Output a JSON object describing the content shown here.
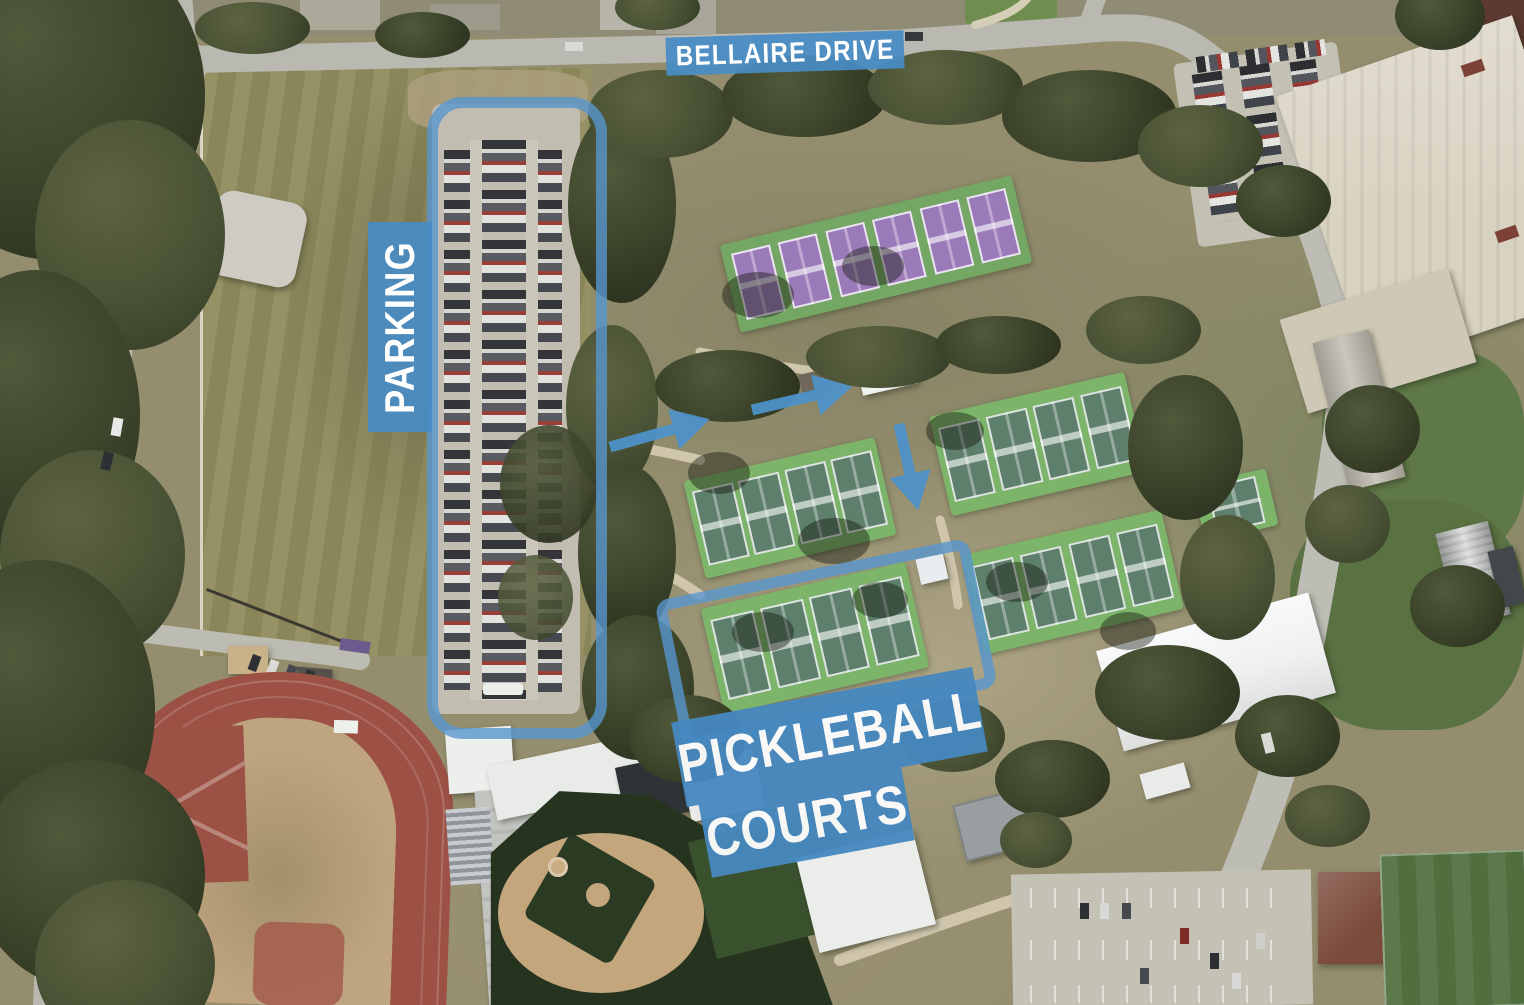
{
  "map": {
    "annotation_color": "#4E92C8",
    "labels": {
      "street": "BELLAIRE DRIVE",
      "parking": "PARKING",
      "pickleball_line1": "PICKLEBALL",
      "pickleball_line2": "COURTS"
    },
    "annotations": {
      "outlines": [
        {
          "name": "parking-lot",
          "shape": "rounded-rectangle"
        },
        {
          "name": "pickleball-courts",
          "shape": "rounded-rectangle"
        }
      ],
      "arrows": [
        {
          "direction": "right"
        },
        {
          "direction": "right"
        },
        {
          "direction": "down"
        }
      ]
    }
  }
}
